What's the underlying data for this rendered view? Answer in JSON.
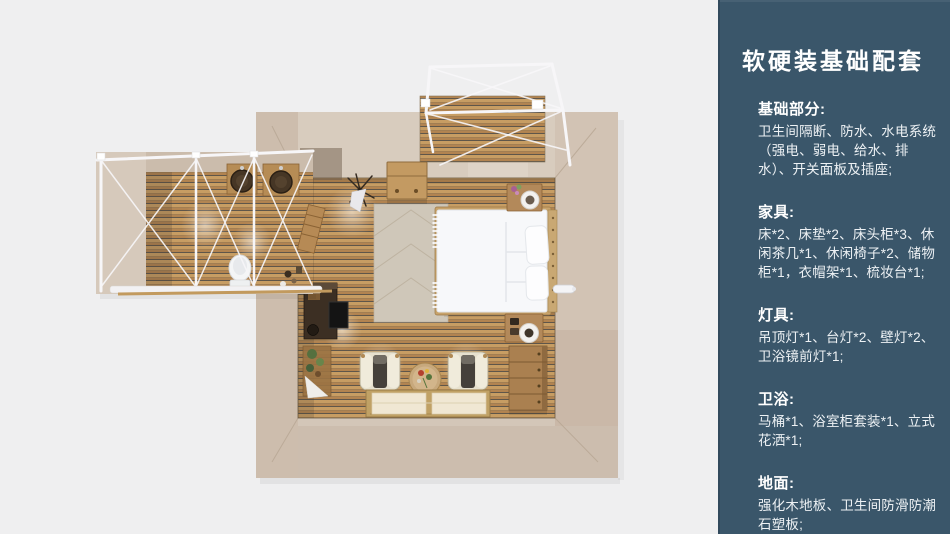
{
  "sidebar": {
    "title": "软硬装基础配套",
    "sections": [
      {
        "id": "basics",
        "heading": "基础部分:",
        "body": "卫生间隔断、防水、水电系统（强电、弱电、给水、排水）、开关面板及插座;"
      },
      {
        "id": "furniture",
        "heading": "家具:",
        "body": "床*2、床垫*2、床头柜*3、休闲茶几*1、休闲椅子*2、储物柜*1，衣帽架*1、梳妆台*1;"
      },
      {
        "id": "lighting",
        "heading": "灯具:",
        "body": "吊顶灯*1、台灯*2、壁灯*2、卫浴镜前灯*1;"
      },
      {
        "id": "bathroom",
        "heading": "卫浴:",
        "body": "马桶*1、浴室柜套装*1、立式花洒*1;"
      },
      {
        "id": "flooring",
        "heading": "地面:",
        "body": "强化木地板、卫生间防滑防潮石塑板;"
      }
    ]
  },
  "colors": {
    "canvas_bg": "#efeff0",
    "sidebar_bg": "#3a566a",
    "sidebar_border": "#31495c",
    "sidebar_text": "#ffffff",
    "sidebar_body_text": "#edf1f4",
    "wall": "#d3c6b8",
    "wood_plank": "#c79d63",
    "wood_gap": "#5f564a",
    "white_frame": "#f7f6f8",
    "bed_white": "#f7f8fa",
    "rug": "#cfc7b9",
    "cabinet_wood": "#aa8050",
    "mat_cream": "#f0e7d3"
  },
  "floorplan": {
    "view": "top-down 3D render",
    "areas": [
      "bedroom",
      "bathroom-annex",
      "balcony"
    ],
    "furniture_visible": [
      "double-bed",
      "pillows",
      "headboard",
      "nightstand-top",
      "nightstand-bottom",
      "table-lamps",
      "rug",
      "chest-of-drawers",
      "tv-console",
      "tv",
      "plant-shelf",
      "coat-rack",
      "storage-box",
      "armchair-left",
      "armchair-right",
      "tea-table",
      "floor-mats",
      "wall-lamp",
      "bathroom-sinks",
      "toilet",
      "balcony-canopy-frame"
    ]
  }
}
